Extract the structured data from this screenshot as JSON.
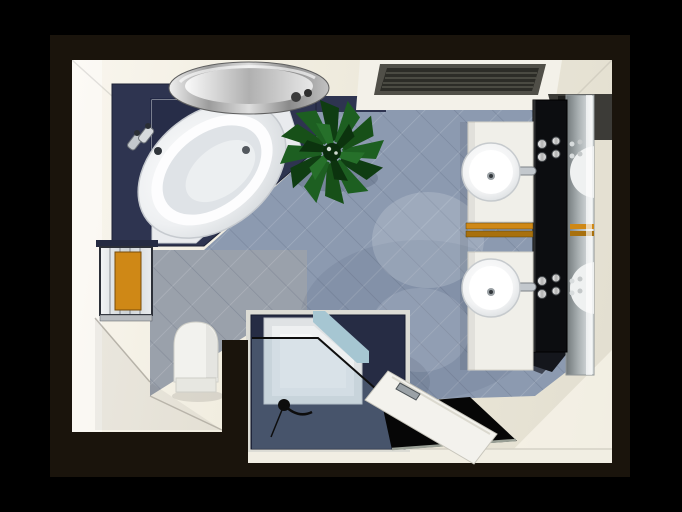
{
  "scene": {
    "kind": "3d-architectural-render",
    "view": "top-down",
    "room": "bathroom",
    "frame": "black border"
  },
  "palette": {
    "frame_black": "#000000",
    "backdrop_brown": "#1a140c",
    "wall_cream": "#f0ecdf",
    "floor_tile_blue": "#8c9ab0",
    "wall_tile_gray": "#9aa1ab",
    "platform_navy": "#2e3450",
    "platform_navy_dark": "#232946",
    "shower_navy": "#262c44",
    "fixture_white": "#f2f2ee",
    "vanity_black": "#0c0d10",
    "mirror_gray": "#aeb4b6",
    "towel_orange": "#cf8816",
    "towel_orange_dark": "#a8700d",
    "plant_green": "#1d5f21",
    "chrome_silver": "#c3c8cd",
    "glass_blue": "#a6c6d2",
    "doorway_black": "#060606"
  },
  "objects": {
    "corner_bathtub": {
      "label": "Corner whirlpool bathtub"
    },
    "bathtub_platform": {
      "label": "Navy tiled bathtub platform"
    },
    "bathtub_faucet": {
      "label": "Chrome bathtub faucet"
    },
    "side_table": {
      "label": "Round chrome side table"
    },
    "plant": {
      "label": "Green potted plant"
    },
    "ceiling_vent": {
      "label": "Ceiling ventilation grille"
    },
    "window": {
      "label": "Glazed window with orange towel"
    },
    "toilet": {
      "label": "Wall-hung toilet"
    },
    "shower": {
      "label": "Walk-in shower enclosure"
    },
    "shower_glass": {
      "label": "Tinted glass shower screen"
    },
    "shower_handset": {
      "label": "Hand shower on hose"
    },
    "entrance_door": {
      "label": "Open entrance door"
    },
    "doorway": {
      "label": "Dark doorway opening"
    },
    "vanity_counter": {
      "label": "Double washbasin counter"
    },
    "washbasin_top": {
      "label": "Round countertop washbasin"
    },
    "washbasin_bottom": {
      "label": "Round countertop washbasin"
    },
    "vanity_panel": {
      "label": "Black fixture panel with chrome valves"
    },
    "mirror": {
      "label": "Wall mirror"
    },
    "towel_rail": {
      "label": "Orange towels on rail"
    },
    "floor": {
      "label": "Blue-grey diagonal floor tiles"
    },
    "gray_tiles": {
      "label": "Grey tiled wall section"
    }
  }
}
